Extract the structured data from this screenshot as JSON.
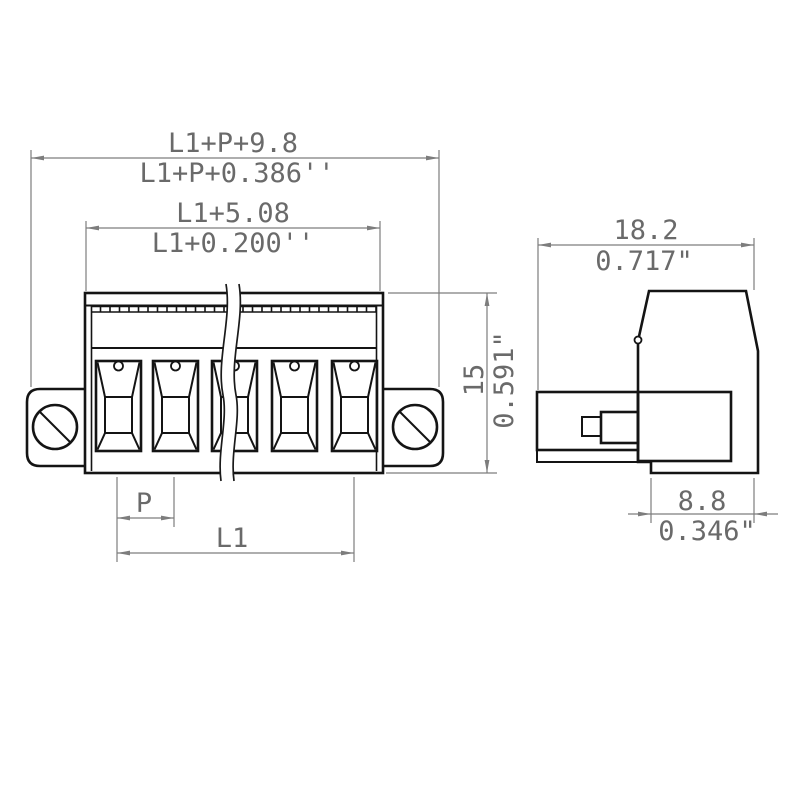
{
  "drawing": {
    "type": "technical-dimension-drawing",
    "subject": "pluggable screw terminal block connector, front and side views",
    "front_view": {
      "poles_shown": 5,
      "dim_total_width_mm": "L1+P+9.8",
      "dim_total_width_in": "L1+P+0.386''",
      "dim_housing_width_mm": "L1+5.08",
      "dim_housing_width_in": "L1+0.200''",
      "dim_height_mm": "15",
      "dim_height_in": "0.591\"",
      "dim_pitch": "P",
      "dim_length": "L1"
    },
    "side_view": {
      "dim_depth_mm": "18.2",
      "dim_depth_in": "0.717\"",
      "dim_foot_depth_mm": "8.8",
      "dim_foot_depth_in": "0.346\""
    },
    "colors": {
      "background": "#ffffff",
      "outline": "#141414",
      "dimension_lines": "#7d7d7d",
      "dimension_text": "#6a6a6a"
    }
  }
}
